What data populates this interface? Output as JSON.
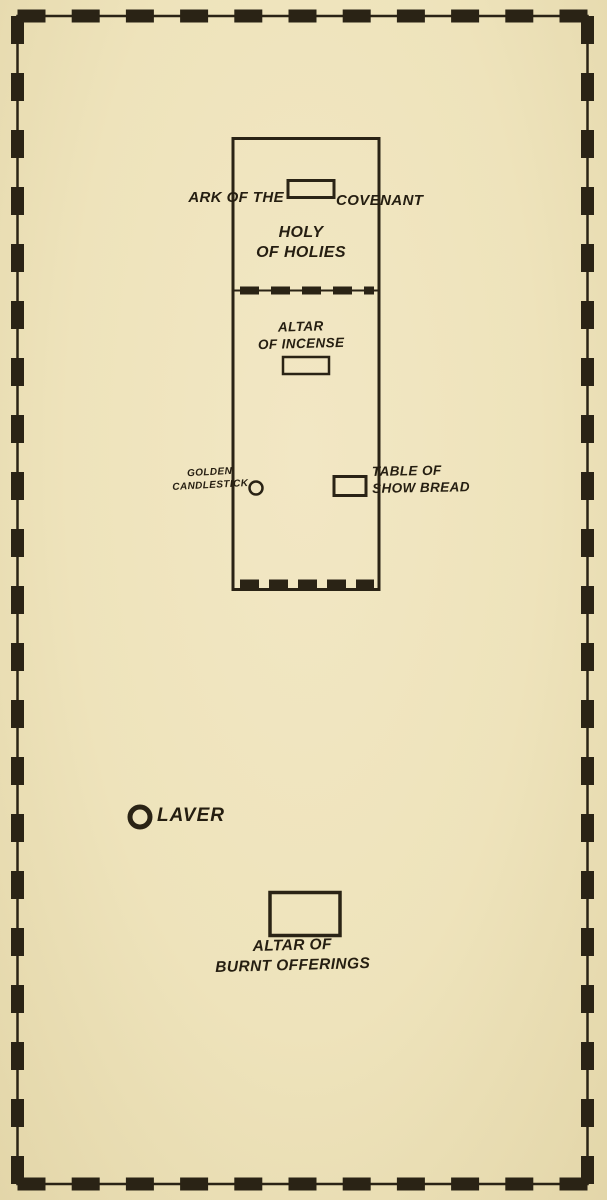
{
  "diagram": {
    "type": "floor-plan",
    "labels": {
      "ark_of_the": "ARK OF THE",
      "covenant": "COVENANT",
      "holy_of_holies": "HOLY\nOF HOLIES",
      "altar_of_incense": "ALTAR\nOF INCENSE",
      "golden_candlestick": "GOLDEN\nCANDLESTICK",
      "table_of_showbread": "TABLE OF\nSHOW BREAD",
      "laver": "LAVER",
      "altar_of_burnt_offerings": "ALTAR OF\nBURNT OFFERINGS"
    },
    "features": [
      {
        "id": "courtyard-border",
        "shape": "dashed-rectangle",
        "meaning": "outer court fence"
      },
      {
        "id": "tabernacle-outline",
        "shape": "rectangle",
        "meaning": "tabernacle tent"
      },
      {
        "id": "veil-divider",
        "shape": "dashed-line",
        "meaning": "veil between Holy of Holies and Holy Place"
      },
      {
        "id": "tabernacle-entrance",
        "shape": "dashed-line",
        "meaning": "entrance curtain"
      },
      {
        "id": "ark-of-the-covenant",
        "shape": "small-rectangle"
      },
      {
        "id": "altar-of-incense",
        "shape": "small-rectangle"
      },
      {
        "id": "golden-candlestick",
        "shape": "small-circle"
      },
      {
        "id": "table-of-showbread",
        "shape": "small-rectangle"
      },
      {
        "id": "laver",
        "shape": "bold-circle"
      },
      {
        "id": "altar-of-burnt-offerings",
        "shape": "rectangle"
      }
    ],
    "colors": {
      "paper": "#eee3bb",
      "ink": "#2a2315"
    }
  }
}
